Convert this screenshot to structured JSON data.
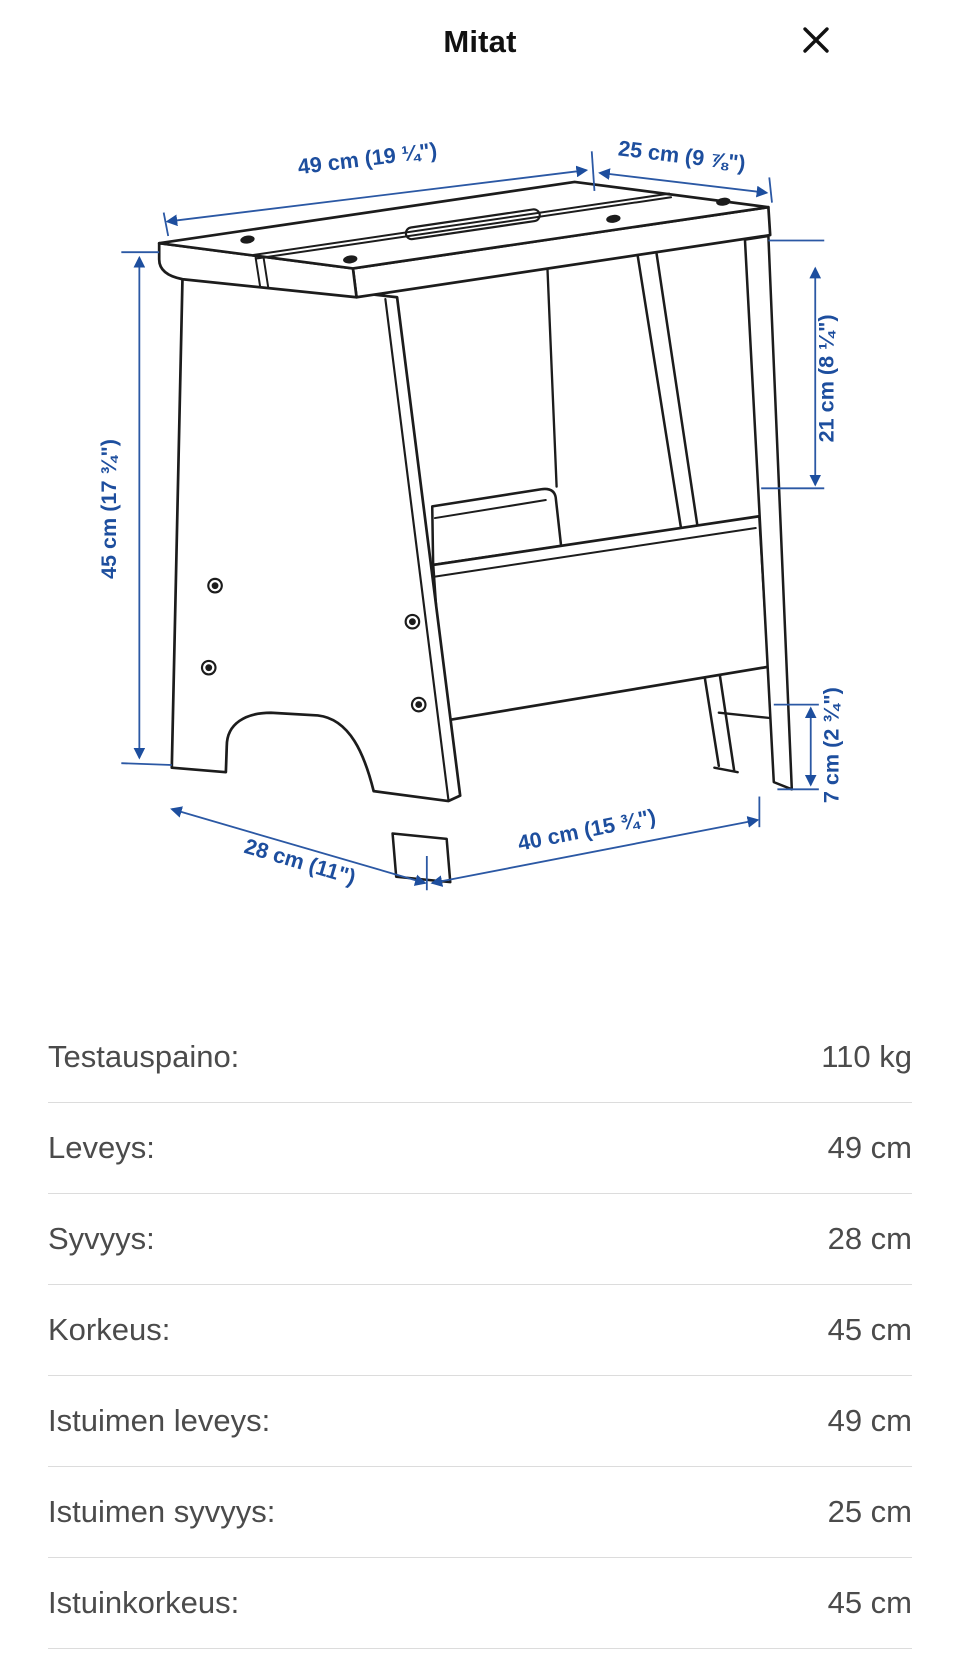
{
  "header": {
    "title": "Mitat",
    "close": "close"
  },
  "drawing": {
    "dimensions": {
      "seat_width_top": "49 cm (19 ¼\")",
      "seat_depth_top": "25 cm (9 ⅞\")",
      "height_left": "45 cm (17 ¾\")",
      "side_opening_height": "21 cm (8 ¼\")",
      "foot_height": "7 cm (2 ¾\")",
      "depth_bottom": "28 cm (11\")",
      "width_bottom": "40 cm (15 ¾\")"
    },
    "colors": {
      "dimension_blue": "#1d4e9e",
      "outline_black": "#1c1c1c"
    }
  },
  "specs": {
    "rows": [
      {
        "label": "Testauspaino:",
        "value": "110 kg"
      },
      {
        "label": "Leveys:",
        "value": "49 cm"
      },
      {
        "label": "Syvyys:",
        "value": "28 cm"
      },
      {
        "label": "Korkeus:",
        "value": "45 cm"
      },
      {
        "label": "Istuimen leveys:",
        "value": "49 cm"
      },
      {
        "label": "Istuimen syvyys:",
        "value": "25 cm"
      },
      {
        "label": "Istuinkorkeus:",
        "value": "45 cm"
      }
    ]
  }
}
